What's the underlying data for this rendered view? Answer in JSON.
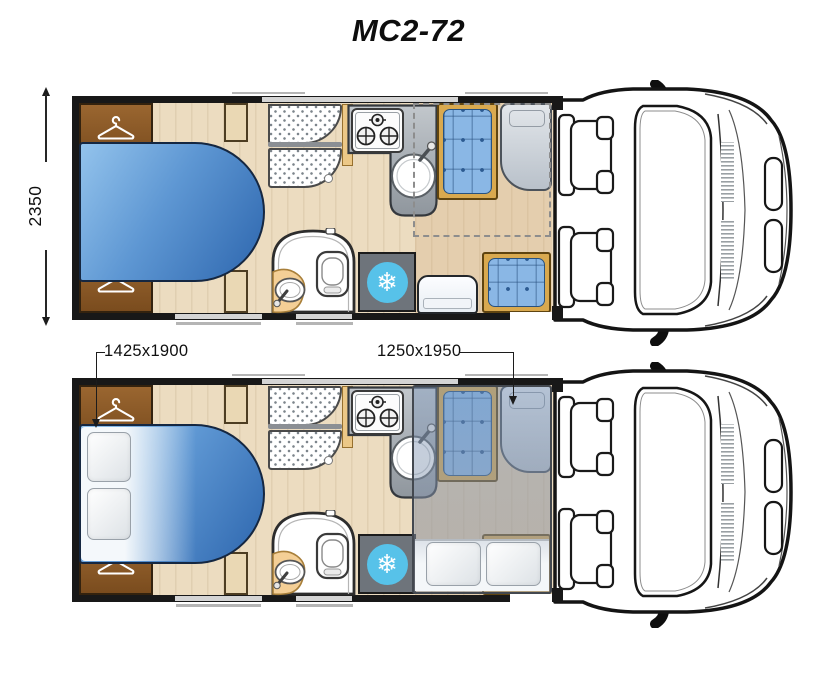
{
  "title": "MC2-72",
  "dimensions": {
    "overall_width_mm": "2350",
    "rear_bed_size_mm": "1425x1900",
    "drop_down_bed_size_mm": "1250x1950"
  },
  "icons": {
    "freezer_snowflake": "❄"
  },
  "colors": {
    "bed_blue": "#3f7fc4",
    "cushion_blue": "#8ab7e5",
    "wardrobe_brown": "#8a5a28",
    "kitchen_grey": "#a9b0b7",
    "freezer_badge": "#57c2e9",
    "floor_wood": "#ecdcc0",
    "wall_black": "#181818"
  }
}
